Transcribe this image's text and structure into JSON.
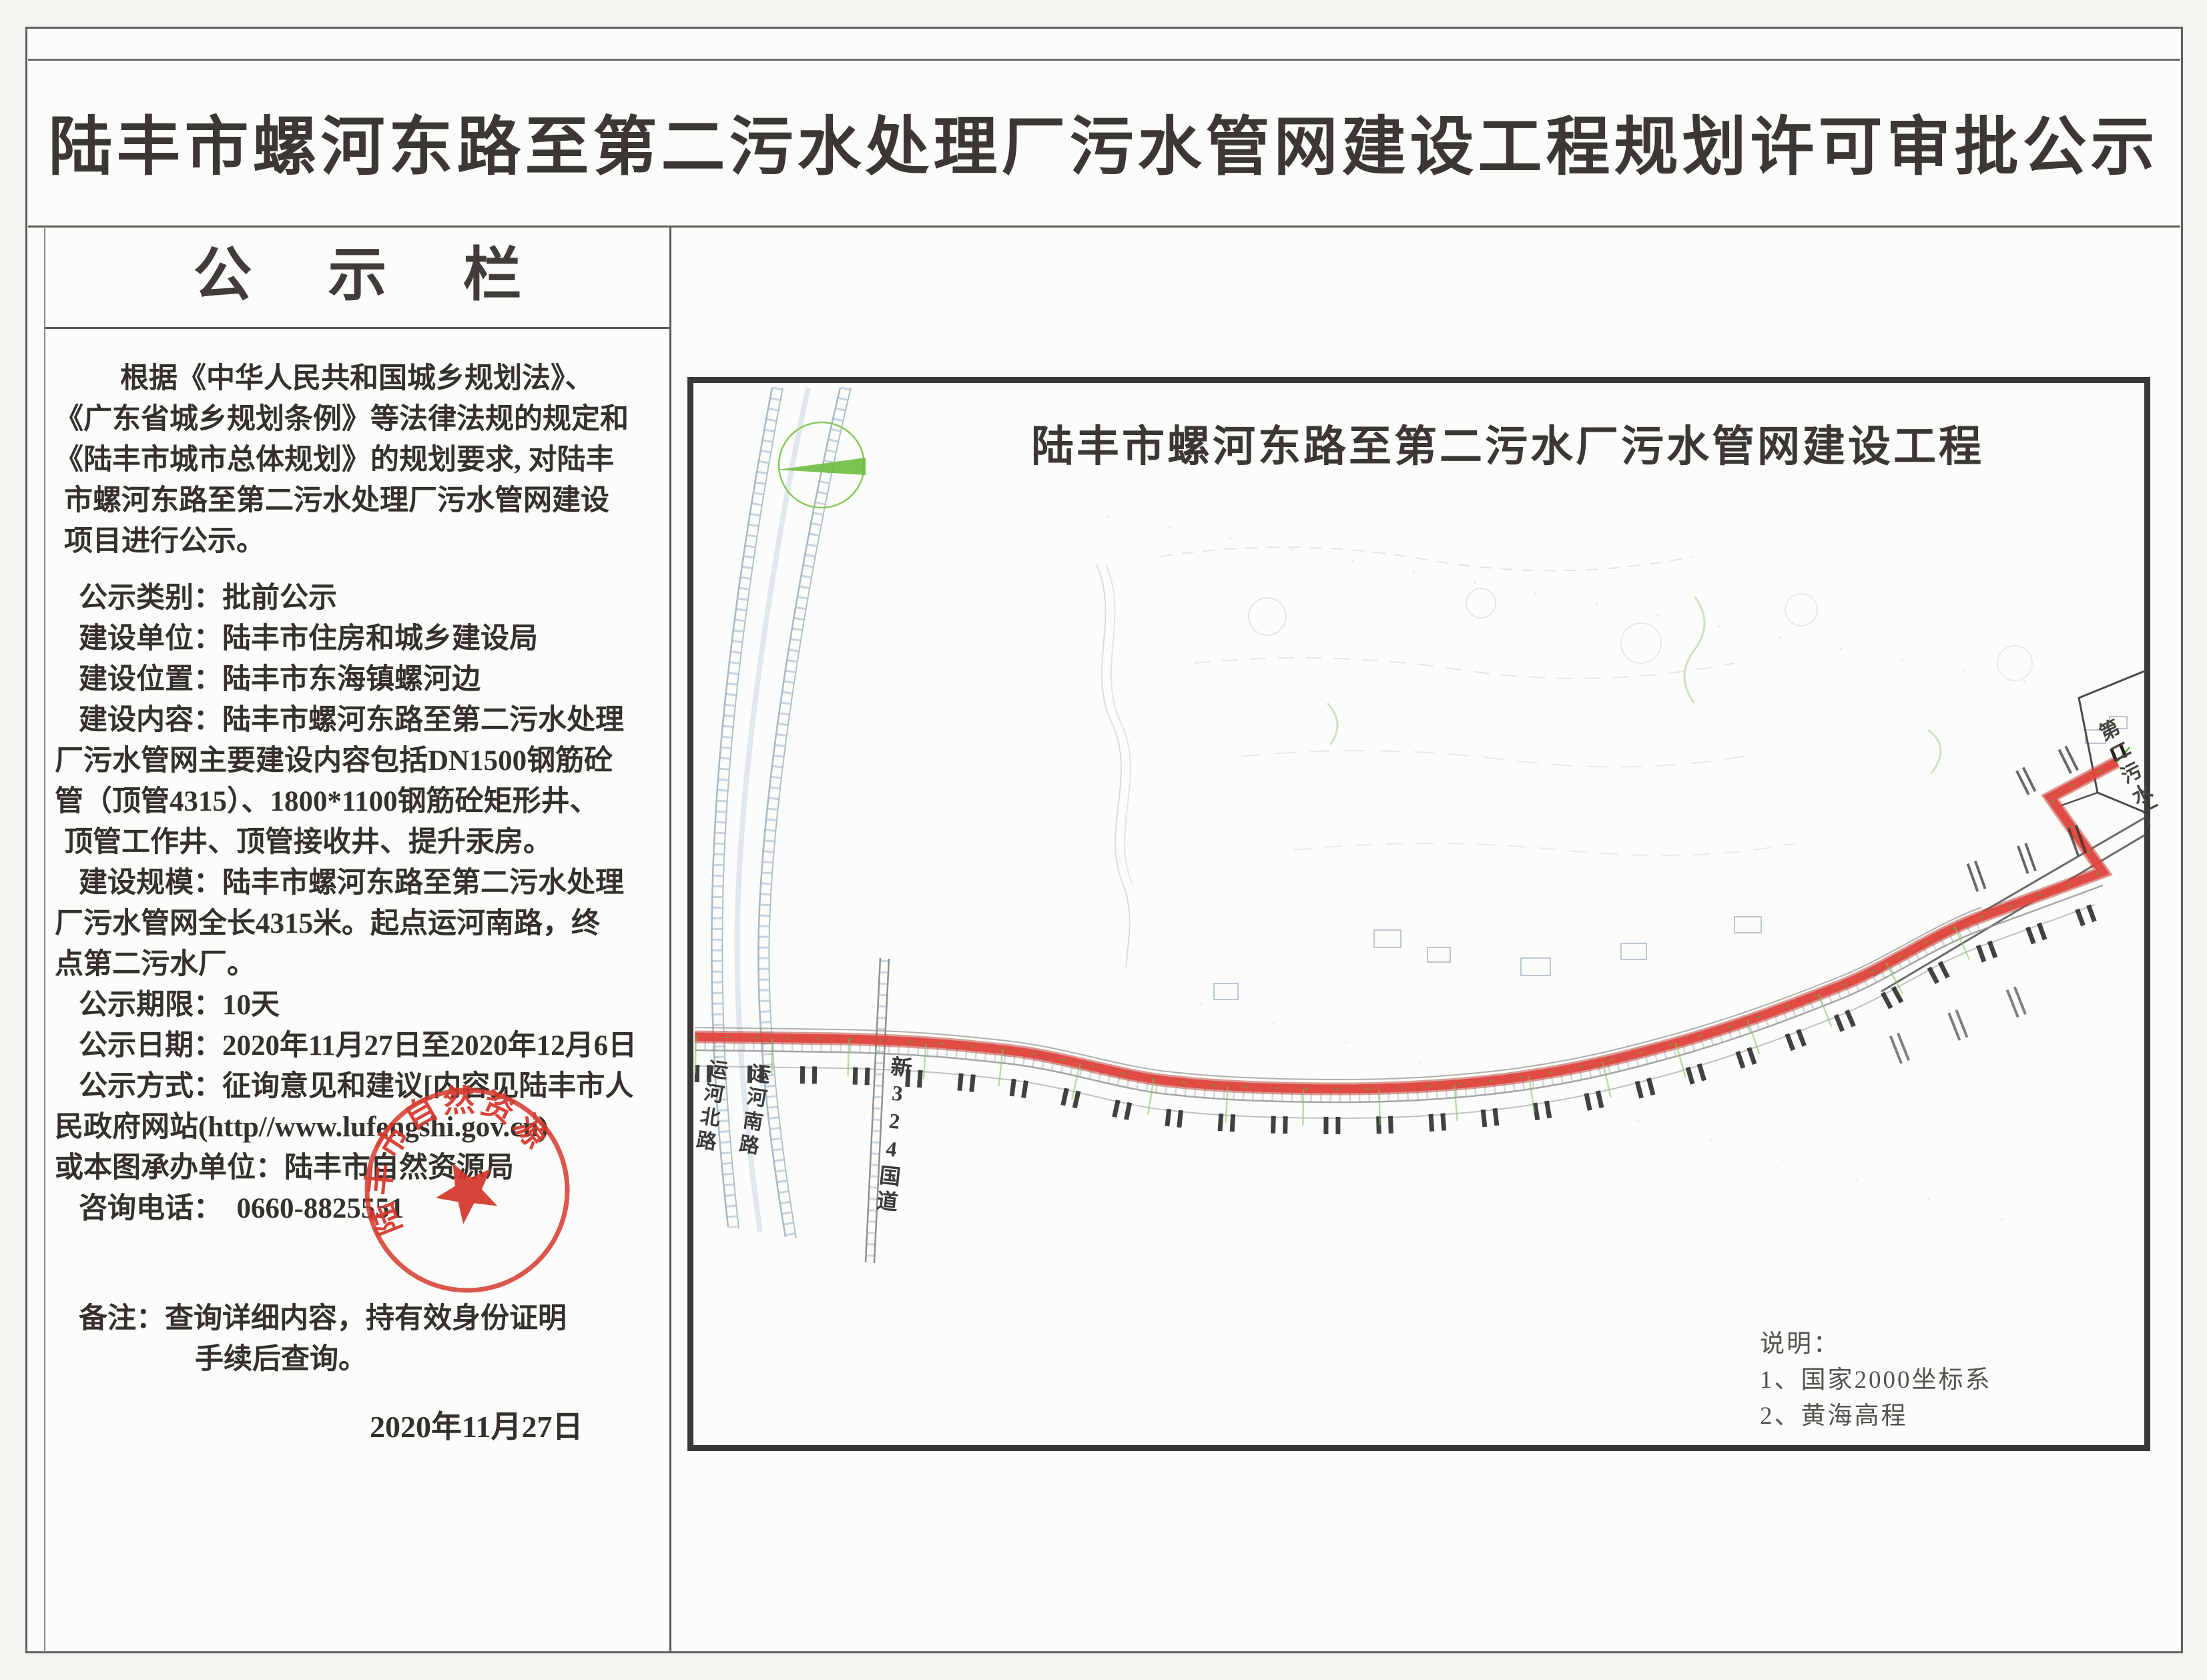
{
  "header": {
    "title": "陆丰市螺河东路至第二污水处理厂污水管网建设工程规划许可审批公示"
  },
  "board": {
    "heading": "公 示 栏",
    "intro": [
      {
        "t": "根据《中华人民共和国城乡规划法》、",
        "c": "b"
      },
      {
        "t": "《广东省城乡规划条例》等法律法规的规定和",
        "c": "z"
      },
      {
        "t": "《陆丰市城市总体规划》的规划要求, 对陆丰",
        "c": "z"
      },
      {
        "t": "市螺河东路至第二污水处理厂污水管网建设",
        "c": ""
      },
      {
        "t": "项目进行公示。",
        "c": ""
      }
    ],
    "fields": [
      {
        "t": "公示类别：批前公示",
        "c": "a"
      },
      {
        "t": "建设单位：陆丰市住房和城乡建设局",
        "c": "a"
      },
      {
        "t": "建设位置：陆丰市东海镇螺河边",
        "c": "a"
      },
      {
        "t": "建设内容：陆丰市螺河东路至第二污水处理",
        "c": "a"
      },
      {
        "t": "厂污水管网主要建设内容包括DN1500钢筋砼",
        "c": "z"
      },
      {
        "t": "管（顶管4315）、1800*1100钢筋砼矩形井、",
        "c": "z"
      },
      {
        "t": "顶管工作井、顶管接收井、提升汞房。",
        "c": ""
      },
      {
        "t": "建设规模：陆丰市螺河东路至第二污水处理",
        "c": "a"
      },
      {
        "t": "厂污水管网全长4315米。起点运河南路，终",
        "c": "z"
      },
      {
        "t": "点第二污水厂。",
        "c": "z"
      },
      {
        "t": "公示期限：10天",
        "c": "a"
      },
      {
        "t": "公示日期：2020年11月27日至2020年12月6日",
        "c": "a"
      },
      {
        "t": "公示方式：征询意见和建议[内容见陆丰市人",
        "c": "a"
      },
      {
        "t": "民政府网站(http//www.lufengshi.gov.cn)",
        "c": "z"
      },
      {
        "t": "或本图承办单位：陆丰市自然资源局",
        "c": "z"
      },
      {
        "t": "咨询电话：  0660-8825551",
        "c": "a"
      }
    ],
    "remarks": [
      {
        "t": "备注：查询详细内容，持有效身份证明",
        "c": "a"
      },
      {
        "t": "手续后查询。",
        "c": "c"
      }
    ],
    "date": "2020年11月27日"
  },
  "seal": {
    "text": "陆丰市自然资源局",
    "color": "#d5372c"
  },
  "map": {
    "title": "陆丰市螺河东路至第二污水厂污水管网建设工程",
    "route_color": "#e0473f",
    "labels": {
      "canal_north": "运河北路",
      "canal_south": "运河南路",
      "g324": "新324国道",
      "plant": "第二污水厂"
    },
    "legend": {
      "heading": "说明：",
      "item1": "1、国家2000坐标系",
      "item2": "2、黄海高程"
    }
  }
}
